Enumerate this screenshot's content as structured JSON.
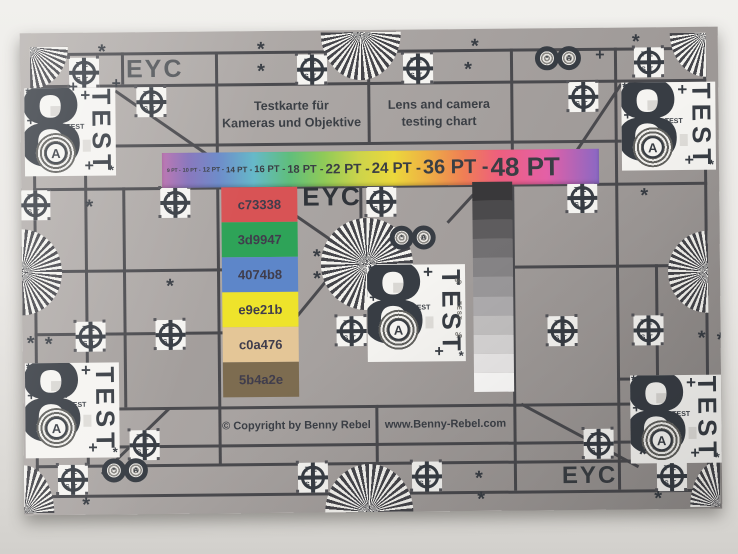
{
  "photo": {
    "description": "Photograph of a printed lens and camera test chart on a light surface"
  },
  "chart": {
    "brand": "EYC",
    "title_de": {
      "line1": "Testkarte für",
      "line2": "Kameras und Objektive"
    },
    "title_en": {
      "line1": "Lens and camera",
      "line2": "testing chart"
    },
    "copyright": "© Copyright by Benny Rebel",
    "website": "www.Benny-Rebel.com",
    "icons": {
      "figure_eight": "8",
      "aperture_a": "A",
      "test": "TEST",
      "crosshair_top": "TE",
      "crosshair_bottom": "ST",
      "asterisk": "*",
      "plus": "+",
      "percent": "%"
    },
    "pt_scale": {
      "labels": [
        "9 PT",
        "10 PT",
        "12 PT",
        "14 PT",
        "16 PT",
        "18 PT",
        "22 PT",
        "24 PT",
        "36 PT",
        "48 PT"
      ],
      "px": [
        5,
        5.5,
        6.5,
        8,
        9.5,
        11,
        13.5,
        15,
        20,
        26
      ],
      "separator": " -"
    },
    "rainbow_stops": [
      {
        "color": "#b96fae",
        "pos": 0
      },
      {
        "color": "#8472bb",
        "pos": 6
      },
      {
        "color": "#6b8ac9",
        "pos": 13
      },
      {
        "color": "#66b9c9",
        "pos": 21
      },
      {
        "color": "#5fbe7d",
        "pos": 29
      },
      {
        "color": "#8fca58",
        "pos": 37
      },
      {
        "color": "#ccd44b",
        "pos": 45
      },
      {
        "color": "#ecd83b",
        "pos": 53
      },
      {
        "color": "#eeae45",
        "pos": 61
      },
      {
        "color": "#ef7f55",
        "pos": 69
      },
      {
        "color": "#ee5f7e",
        "pos": 77
      },
      {
        "color": "#e360a6",
        "pos": 88
      },
      {
        "color": "#8a68c4",
        "pos": 100
      }
    ],
    "color_swatches": [
      {
        "label": "c73338",
        "display": "#d85355"
      },
      {
        "label": "3d9947",
        "display": "#2ea358"
      },
      {
        "label": "4074b8",
        "display": "#5d86c9"
      },
      {
        "label": "e9e21b",
        "display": "#eee32b"
      },
      {
        "label": "c0a476",
        "display": "#e4c697"
      },
      {
        "label": "5b4a2e",
        "display": "#7d6c50"
      }
    ],
    "grayscale_steps": [
      "#39383a",
      "#4b4a4c",
      "#5e5c5e",
      "#727072",
      "#868486",
      "#9a989a",
      "#aeacae",
      "#c2c0c0",
      "#d6d4d4",
      "#e9e7e7",
      "#fbfaf9"
    ],
    "colors": {
      "line": "#4a4a4e",
      "ink": "#383d44",
      "paper_white": "#f5f4f1",
      "fan_dark": "#45454a",
      "fan_light": "#f3f2ee"
    }
  }
}
